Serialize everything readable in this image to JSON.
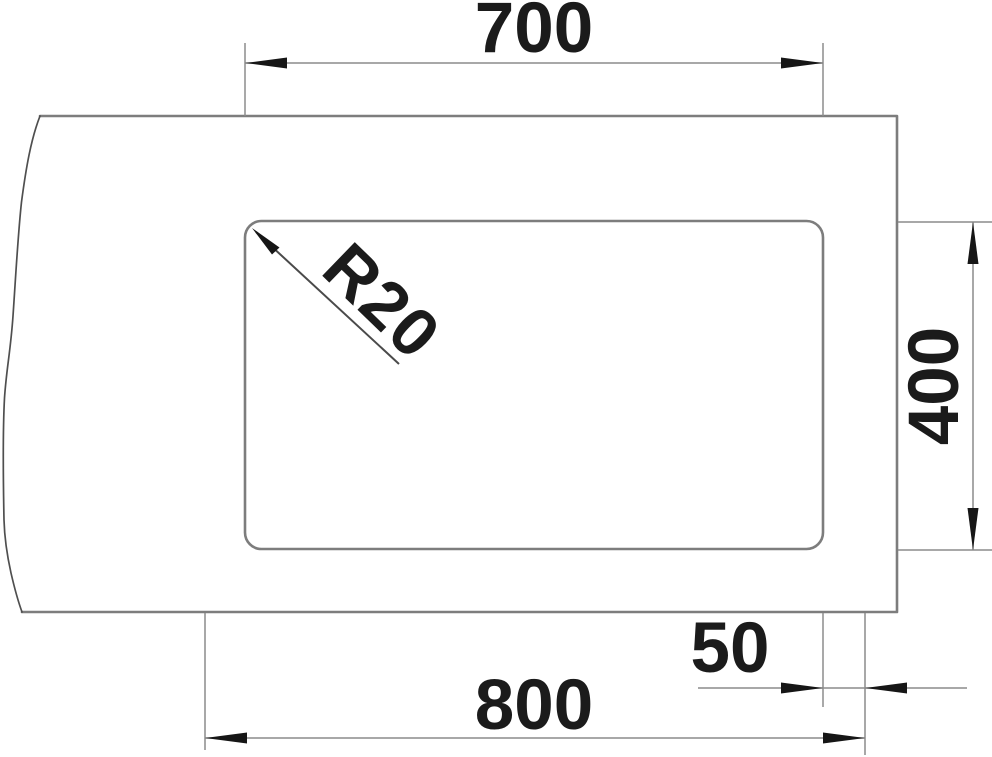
{
  "drawing": {
    "labels": {
      "top_width": "700",
      "side_height": "400",
      "bottom_width": "800",
      "edge_offset": "50",
      "corner_radius": "R20"
    },
    "colors": {
      "outline": "#7d7d7d",
      "dimension_lines": "#8c8c8c",
      "broken_edge": "#4f4f4f",
      "text": "#1b1b1b",
      "background": "#ffffff"
    }
  }
}
